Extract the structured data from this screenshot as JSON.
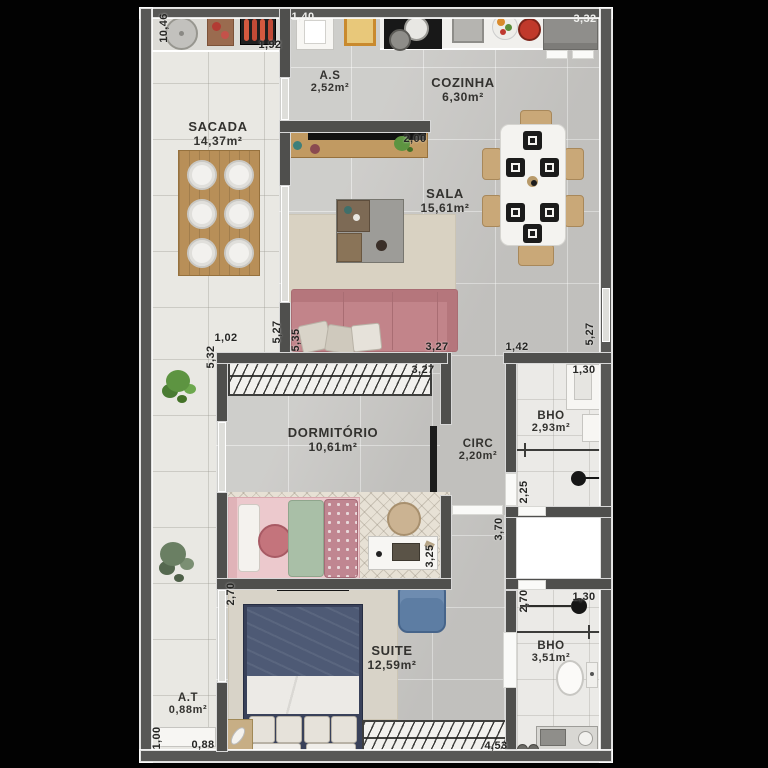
{
  "plan": {
    "type": "apartment-floor-plan",
    "rooms": {
      "sacada": {
        "name": "SACADA",
        "area": "14,37m²"
      },
      "servico": {
        "name": "A.S",
        "area": "2,52m²"
      },
      "cozinha": {
        "name": "COZINHA",
        "area": "6,30m²"
      },
      "sala": {
        "name": "SALA",
        "area": "15,61m²"
      },
      "dormitorio": {
        "name": "DORMITÓRIO",
        "area": "10,61m²"
      },
      "circ": {
        "name": "CIRC",
        "area": "2,20m²"
      },
      "bho_sup": {
        "name": "BHO",
        "area": "2,93m²"
      },
      "suite": {
        "name": "SUITE",
        "area": "12,59m²"
      },
      "bho_inf": {
        "name": "BHO",
        "area": "3,51m²"
      },
      "at": {
        "name": "A.T",
        "area": "0,88m²"
      }
    },
    "dims": {
      "d10_46": "10,46",
      "d1_92": "1,92",
      "d1_40": "1,40",
      "d3_32": "3,32",
      "d2_00": "2,00",
      "d1_02": "1,02",
      "d5_32": "5,32",
      "d5_27_l": "5,27",
      "d5_35": "5,35",
      "d3_27_a": "3,27",
      "d3_27_b": "3,27",
      "d1_42": "1,42",
      "d5_27_r": "5,27",
      "d1_30_a": "1,30",
      "d2_25": "2,25",
      "d3_70": "3,70",
      "d2_70_r": "2,70",
      "d1_30_b": "1,30",
      "d2_70_l": "2,70",
      "d3_25": "3,25",
      "d1_00": "1,00",
      "d0_88": "0,88",
      "d4_53": "4,53"
    },
    "colors": {
      "background": "#020202",
      "wall": "#4f4f4d",
      "floor_main": "#c9c8c5",
      "floor_balcony": "#e9e8e3",
      "floor_bath": "#ebeae7",
      "sofa_pink": "#c2848a",
      "suite_bed_navy": "#4e5a75",
      "armchair_blue": "#5d7da3",
      "wood": "#b88f58",
      "plant_green": "#5d9441",
      "rug_beige": "#d9d2c2"
    }
  }
}
